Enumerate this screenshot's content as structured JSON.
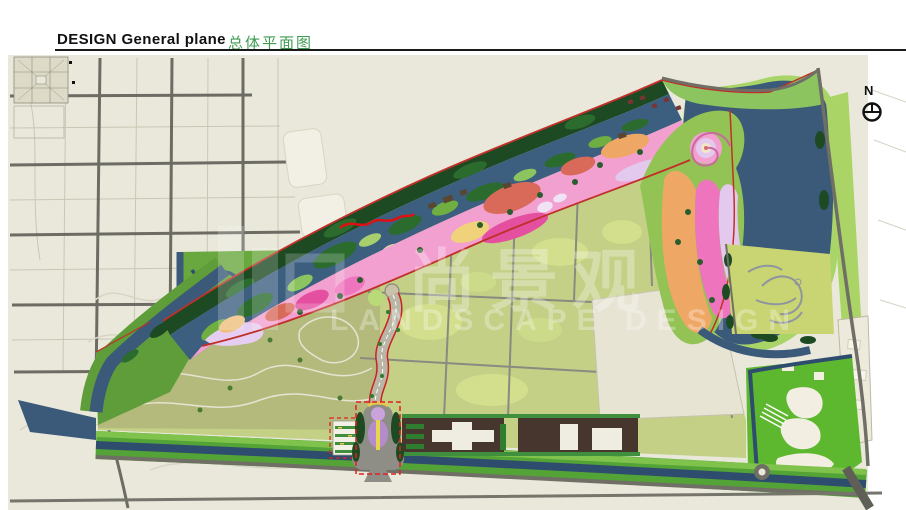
{
  "header": {
    "title_en": "DESIGN General plane",
    "title_cn": "总体平面图"
  },
  "compass": {
    "label": "N"
  },
  "watermark": {
    "cn": "尚景观",
    "en": "LANDSCAPE DESIGN"
  },
  "palette": {
    "paper": "#ffffff",
    "map_background": "#e9e8da",
    "field_green": "#c3d086",
    "field_olive": "#b4ba7c",
    "water_blue": "#3b5a7a",
    "canal_blue": "#2e4d6e",
    "park_green": "#5f9c3a",
    "bright_green": "#5eb82f",
    "tree_dark_green": "#1d4a23",
    "zone_pink": "#f2a0d0",
    "zone_magenta": "#e4509f",
    "zone_lilac": "#e4c9ef",
    "zone_salmon": "#d96a5a",
    "zone_orange": "#efa766",
    "road_dark": "#62625a",
    "boundary_red": "#c03028",
    "accent_red": "#e02020",
    "parking_brown": "#46362e",
    "building_white": "#efede2",
    "title_green": "#3f9b52"
  }
}
